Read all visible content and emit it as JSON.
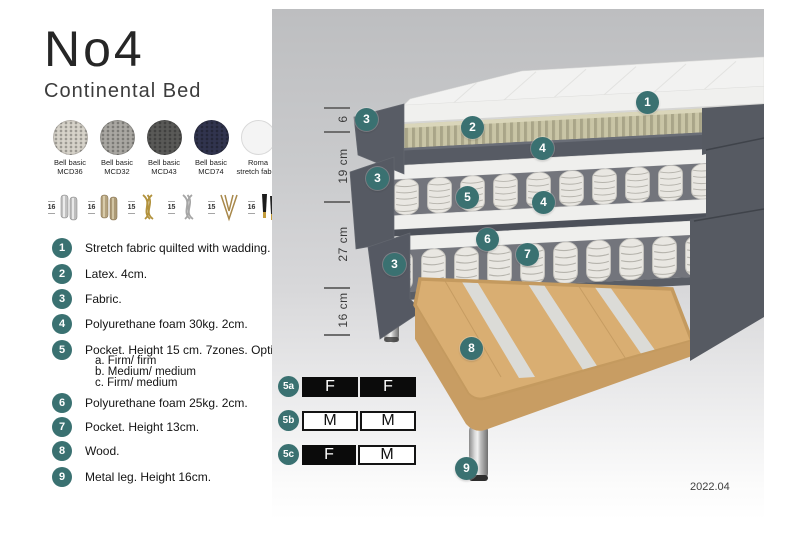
{
  "header": {
    "title": "No4",
    "subtitle": "Continental Bed"
  },
  "fabric_swatches": [
    {
      "name": "Bell basic",
      "code": "MCD36",
      "color": "#d6d2c9"
    },
    {
      "name": "Bell basic",
      "code": "MCD32",
      "color": "#a9a7a2"
    },
    {
      "name": "Bell basic",
      "code": "MCD43",
      "color": "#595957"
    },
    {
      "name": "Bell basic",
      "code": "MCD74",
      "color": "#31344e"
    },
    {
      "name": "Roma",
      "code": "stretch fabric",
      "color": "#f4f4f4"
    }
  ],
  "leg_options": [
    {
      "height": "16",
      "style": "cylinder-silver"
    },
    {
      "height": "16",
      "style": "cylinder-bronze"
    },
    {
      "height": "15",
      "style": "twisted-gold"
    },
    {
      "height": "15",
      "style": "twisted-silver"
    },
    {
      "height": "15",
      "style": "hairpin-gold"
    },
    {
      "height": "16",
      "style": "tapered-black-gold-foot"
    }
  ],
  "parts": [
    {
      "num": "1",
      "label": "Stretch fabric quilted with wadding."
    },
    {
      "num": "2",
      "label": "Latex. 4cm."
    },
    {
      "num": "3",
      "label": "Fabric."
    },
    {
      "num": "4",
      "label": "Polyurethane foam 30kg. 2cm."
    },
    {
      "num": "5",
      "label": "Pocket. Height 15 cm. 7zones. Option:",
      "options": [
        "a. Firm/ firm",
        "b. Medium/ medium",
        "c. Firm/ medium"
      ]
    },
    {
      "num": "6",
      "label": "Polyurethane foam 25kg. 2cm."
    },
    {
      "num": "7",
      "label": "Pocket. Height 13cm."
    },
    {
      "num": "8",
      "label": "Wood."
    },
    {
      "num": "9",
      "label": "Metal leg. Height 16cm."
    }
  ],
  "diagram": {
    "dimensions": [
      {
        "label": "6"
      },
      {
        "label": "19 cm"
      },
      {
        "label": "27 cm"
      },
      {
        "label": "16 cm"
      }
    ],
    "callouts": {
      "c1": "1",
      "c2": "2",
      "c3a": "3",
      "c3b": "3",
      "c3c": "3",
      "c4a": "4",
      "c4b": "4",
      "c5": "5",
      "c6": "6",
      "c7": "7",
      "c8": "8",
      "c9": "9"
    },
    "firmness_options": [
      {
        "id": "5a",
        "cells": [
          {
            "letter": "F",
            "filled": true
          },
          {
            "letter": "F",
            "filled": true
          }
        ]
      },
      {
        "id": "5b",
        "cells": [
          {
            "letter": "M",
            "filled": false
          },
          {
            "letter": "M",
            "filled": false
          }
        ]
      },
      {
        "id": "5c",
        "cells": [
          {
            "letter": "F",
            "filled": true
          },
          {
            "letter": "M",
            "filled": false
          }
        ]
      }
    ],
    "version": "2022.04",
    "accent_color": "#3a7171"
  }
}
